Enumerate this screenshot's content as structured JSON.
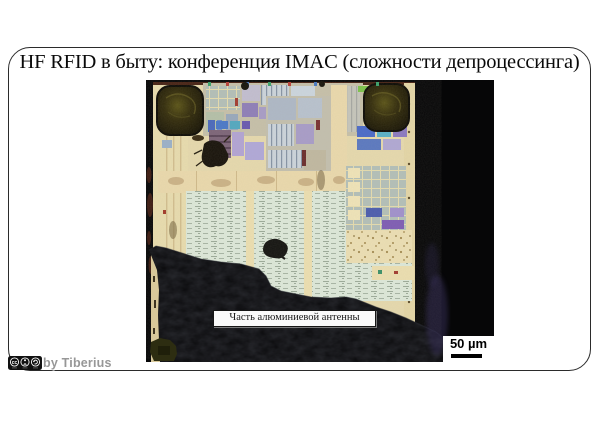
{
  "slide": {
    "title": "HF RFID в быту: конференция IMAC (сложности депроцессинга)"
  },
  "photo": {
    "annotation_label": "Часть алюминиевой антенны",
    "scale_bar_label": "50 µm"
  },
  "footer": {
    "cc_label": "cc",
    "credit": "by Tiberius"
  },
  "palette": {
    "photo_background": "#060607",
    "die_base": "#e6d9ad",
    "standard_cell_area": "#dde8d9",
    "bond_pad": "#26200a",
    "annotation_background": "#fafafa",
    "credit_text": "#979797"
  }
}
